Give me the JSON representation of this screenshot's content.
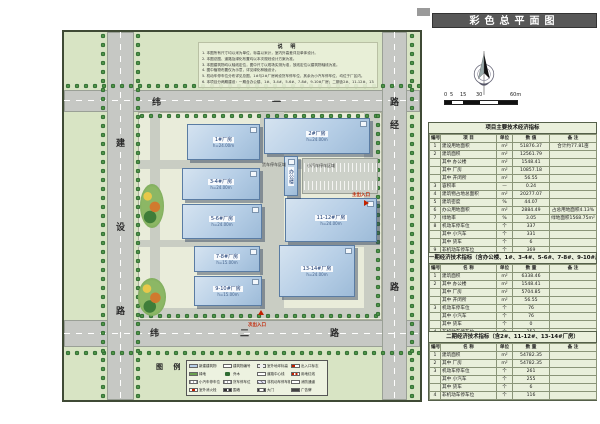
{
  "title_bar": {
    "label": "彩色总平面图"
  },
  "colors": {
    "title_bar_bg": "#585858",
    "grass": "#d8e4c4",
    "road": "#c6c8c4",
    "building_fill": "#b6cee6",
    "table_bg": "#e9efdb",
    "accent_red": "#c22200"
  },
  "notes": {
    "heading": "说 明",
    "lines": [
      "1. 本图所有尺寸均以米为单位，标高以米计，室内外高差详见单体设计。",
      "2. 本图总图、道路及绿化布置均以本次规划设计方案为准。",
      "3. 本图建筑物均以轴线定位，图中尺寸以现场实测为准，放线定位以建筑物轴线为准。",
      "4. 图中植物布置仅为示意，详见绿化种植设计。",
      "5. 机动车停车位分布详见总图，1#与2#厂房间设货车停车位，其余为小汽车停车位，均位于厂区内。",
      "6. 本项目分两期建设：一期含办公楼、1#、3-4#、5-6#、7-8#、9-10#厂房；二期含2#、11-12#、13-14#厂房。"
    ]
  },
  "roads": {
    "west": [
      "建",
      "设",
      "路"
    ],
    "north": [
      "纬",
      "一",
      "路"
    ],
    "east": [
      "经",
      "路"
    ],
    "south": [
      "纬",
      "二",
      "路"
    ]
  },
  "buildings": [
    {
      "label": "1#厂房",
      "sub": "h=24.00m"
    },
    {
      "label": "2#厂房",
      "sub": "h=24.00m"
    },
    {
      "label": "3-4#厂房",
      "sub": "h=24.00m"
    },
    {
      "label": "5-6#厂房",
      "sub": "h=24.00m"
    },
    {
      "label": "7-8#厂房",
      "sub": "h=15.00m"
    },
    {
      "label": "9-10#厂房",
      "sub": "h=15.00m"
    },
    {
      "label": "11-12#厂房",
      "sub": "h=24.00m"
    },
    {
      "label": "13-14#厂房",
      "sub": "h=24.00m"
    },
    {
      "label": "办公楼",
      "sub": ""
    }
  ],
  "parking": {
    "truck_label": "货车停车区域",
    "car_label": "小汽车停车区域"
  },
  "entrances": {
    "main": "主出入口",
    "secondary": "次出入口"
  },
  "scale_bar": {
    "ticks": [
      "0",
      "5",
      "15",
      "30",
      "60m"
    ]
  },
  "tables": [
    {
      "title": "项目主要技术经济指标",
      "headers": [
        "编号",
        "项  目",
        "单位",
        "数  值",
        "备  注"
      ],
      "rows": [
        [
          "1",
          "建设用地面积",
          "m²",
          "51876.37",
          "合计约77.81亩"
        ],
        [
          "2",
          "建筑面积",
          "m²",
          "12561.79",
          ""
        ],
        [
          "",
          "其中 办公楼",
          "m²",
          "1548.41",
          ""
        ],
        [
          "",
          "其中 厂房",
          "m²",
          "10857.18",
          ""
        ],
        [
          "",
          "其中 开闭所",
          "m²",
          "56.55",
          ""
        ],
        [
          "3",
          "容积率",
          "—",
          "0.24",
          ""
        ],
        [
          "4",
          "建筑物占地总面积",
          "m²",
          "20277.07",
          ""
        ],
        [
          "5",
          "建筑密度",
          "%",
          "44.07",
          ""
        ],
        [
          "6",
          "办公用地面积",
          "m²",
          "2884.49",
          "占总用地面积4.13%"
        ],
        [
          "7",
          "绿地率",
          "%",
          "3.05",
          "绿地面积1568.75m²"
        ],
        [
          "8",
          "机动车停车位",
          "个",
          "337",
          ""
        ],
        [
          "",
          "其中 小汽车",
          "个",
          "331",
          ""
        ],
        [
          "",
          "其中 货车",
          "个",
          "6",
          ""
        ],
        [
          "9",
          "非机动车停车位",
          "个",
          "369",
          ""
        ]
      ]
    },
    {
      "title": "一期经济技术指标（含办公楼、1#、3-4#、5-6#、7-8#、9-10#厂房）",
      "headers": [
        "编号",
        "名  称",
        "单位",
        "数  量",
        "备  注"
      ],
      "rows": [
        [
          "1",
          "建筑面积",
          "m²",
          "6338.46",
          ""
        ],
        [
          "2",
          "其中 办公楼",
          "m²",
          "1548.41",
          ""
        ],
        [
          "",
          "其中 厂房",
          "m²",
          "5704.85",
          ""
        ],
        [
          "",
          "其中 开闭所",
          "m²",
          "56.55",
          ""
        ],
        [
          "3",
          "机动车停车位",
          "个",
          "76",
          ""
        ],
        [
          "",
          "其中 小汽车",
          "个",
          "76",
          ""
        ],
        [
          "",
          "其中 货车",
          "个",
          "0",
          ""
        ],
        [
          "4",
          "非机动车停车位",
          "个",
          "253",
          ""
        ]
      ]
    },
    {
      "title": "二期经济技术指标（含2#、11-12#、13-14#厂房）",
      "headers": [
        "编号",
        "名  称",
        "单位",
        "数  量",
        "备  注"
      ],
      "rows": [
        [
          "1",
          "建筑面积",
          "m²",
          "54782.35",
          ""
        ],
        [
          "2",
          "其中 厂房",
          "m²",
          "54782.35",
          ""
        ],
        [
          "3",
          "机动车停车位",
          "个",
          "261",
          ""
        ],
        [
          "",
          "其中 小汽车",
          "个",
          "255",
          ""
        ],
        [
          "",
          "其中 货车",
          "个",
          "6",
          ""
        ],
        [
          "4",
          "非机动车停车位",
          "个",
          "116",
          ""
        ]
      ]
    }
  ],
  "legend": {
    "heading": "图 例",
    "items": [
      {
        "swatch": "bldg",
        "label": "新建建筑物"
      },
      {
        "swatch": "plate",
        "label": "建筑物编号"
      },
      {
        "swatch": "level",
        "label": "室外地坪标高"
      },
      {
        "swatch": "entry",
        "label": "出入口标志"
      },
      {
        "swatch": "green",
        "label": "绿地"
      },
      {
        "swatch": "tree",
        "label": "乔木"
      },
      {
        "swatch": "line",
        "label": "道路中心线"
      },
      {
        "swatch": "redline",
        "label": "用地红线"
      },
      {
        "swatch": "stall",
        "label": "小汽车停车位"
      },
      {
        "swatch": "stall",
        "label": "货车停车位"
      },
      {
        "swatch": "hatch",
        "label": "非机动车停车棚"
      },
      {
        "swatch": "line",
        "label": "消防通道"
      },
      {
        "swatch": "dot",
        "label": "室外消火栓"
      },
      {
        "swatch": "wall",
        "label": "围墙"
      },
      {
        "swatch": "gate",
        "label": "大门"
      },
      {
        "swatch": "dark",
        "label": "广告牌"
      }
    ]
  }
}
